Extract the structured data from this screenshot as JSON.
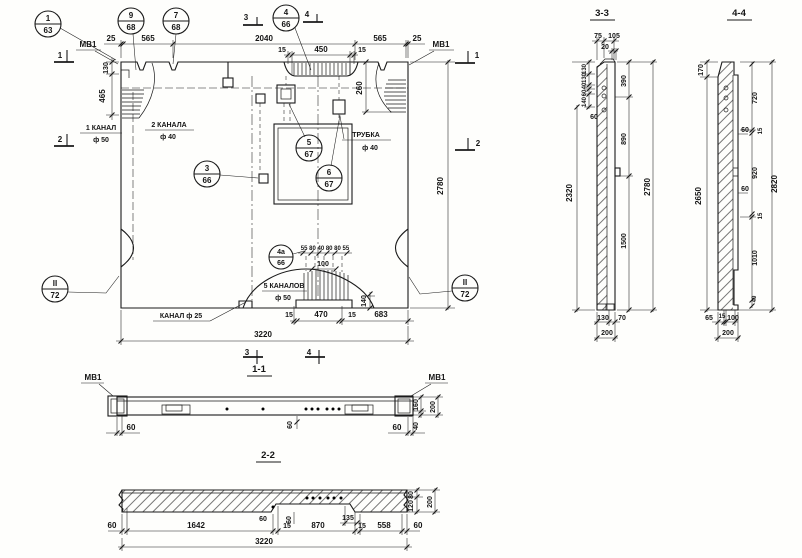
{
  "titles": {
    "s11": "1-1",
    "s22": "2-2",
    "s33": "3-3",
    "s44": "4-4"
  },
  "markers": {
    "top3": "3",
    "top4": "4",
    "bot3": "3",
    "bot4": "4",
    "left1": "1",
    "left2": "2",
    "right1": "1",
    "right2": "2"
  },
  "bubbles": [
    {
      "num": "1",
      "sheet": "63"
    },
    {
      "num": "9",
      "sheet": "68"
    },
    {
      "num": "7",
      "sheet": "68"
    },
    {
      "num": "4",
      "sheet": "66"
    },
    {
      "num": "3",
      "sheet": "66"
    },
    {
      "num": "5",
      "sheet": "67"
    },
    {
      "num": "6",
      "sheet": "67"
    },
    {
      "num": "4а",
      "sheet": "66"
    },
    {
      "num": "II",
      "sheet": "72"
    },
    {
      "num": "II",
      "sheet": "72"
    }
  ],
  "labels": {
    "mv1": "МВ1",
    "ch1_line1": "1 КАНАЛ",
    "ch1_line2": "ф 50",
    "ch2_line1": "2 КАНАЛА",
    "ch2_line2": "ф 40",
    "tube_line1": "ТРУБКА",
    "tube_line2": "ф 40",
    "ch25": "КАНАЛ ф 25",
    "ch5_line1": "5 КАНАЛОВ",
    "ch5_line2": "ф 50"
  },
  "plan": {
    "top": [
      "25",
      "565",
      "2040",
      "565",
      "25"
    ],
    "recess": [
      "15",
      "450",
      "15"
    ],
    "left": [
      "130",
      "465"
    ],
    "right": [
      "260",
      "2780"
    ],
    "bottom": [
      "15",
      "470",
      "15",
      "683"
    ],
    "total": "3220",
    "hump_row": "55 80 40 80 80 55",
    "hump_100": "100",
    "hump_140": "140"
  },
  "s11": {
    "left60": "60",
    "right60": "60",
    "mid60": "60",
    "v160": "160",
    "v40": "40",
    "v200": "200"
  },
  "s22": {
    "row": [
      "60",
      "1642",
      "60",
      "15",
      "870",
      "15",
      "558",
      "60"
    ],
    "d135": "135",
    "mid60": "60",
    "total": "3220",
    "v80": "80",
    "v120": "120",
    "v200": "200"
  },
  "s33": {
    "t75": "75",
    "t105": "105",
    "t20": "20",
    "stack": [
      "130",
      "130",
      "40",
      "60",
      "140"
    ],
    "s60": "60",
    "l2320": "2320",
    "r390": "390",
    "r890": "890",
    "r1500": "1500",
    "r2780": "2780",
    "b130": "130",
    "b70": "70",
    "b200": "200"
  },
  "s44": {
    "l170": "170",
    "l2650": "2650",
    "stack": [
      "720",
      "15",
      "920",
      "15",
      "1010",
      "40"
    ],
    "s60a": "60",
    "s60b": "60",
    "r2820": "2820",
    "b65": "65",
    "b15": "15",
    "b100": "100",
    "b200": "200"
  }
}
